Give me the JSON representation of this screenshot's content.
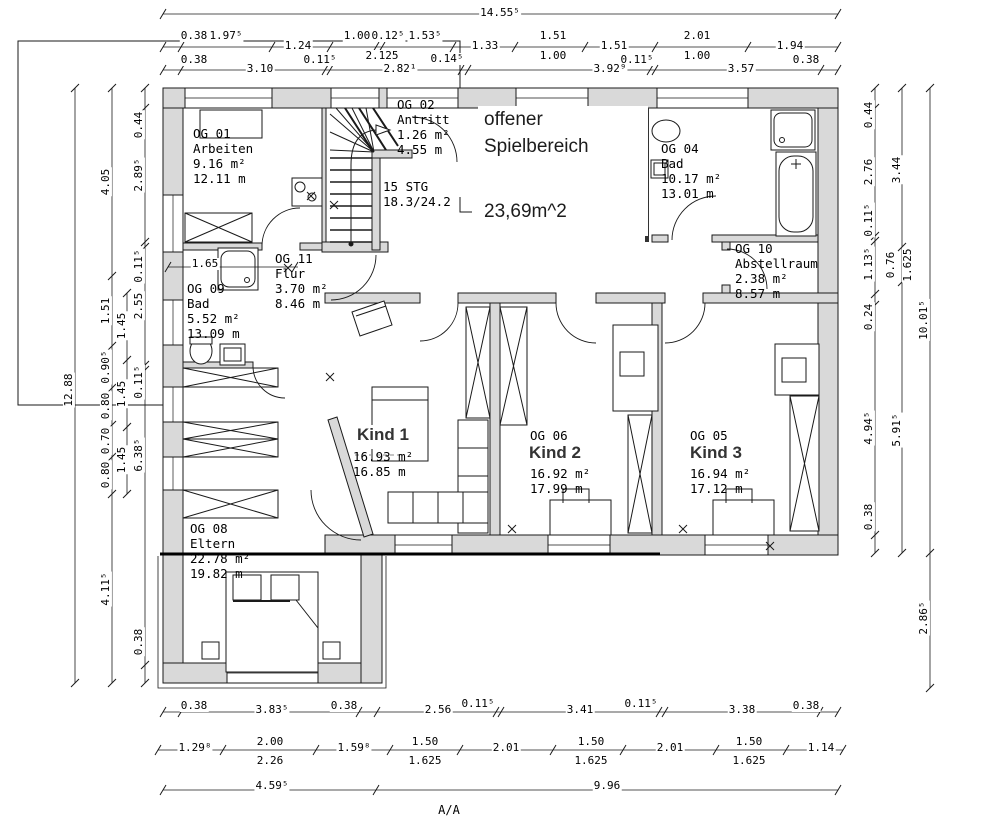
{
  "annotations": {
    "spiel_line1": "offener",
    "spiel_line2": "Spielbereich",
    "spiel_line3": "23,69m^2",
    "kind1": "Kind 1",
    "kind2": "Kind 2",
    "kind3": "Kind 3"
  },
  "rooms": {
    "og01": {
      "id": "OG 01",
      "name": "Arbeiten",
      "area": "9.16 m²",
      "perimeter": "12.11 m"
    },
    "og02": {
      "id": "OG 02",
      "name": "Antritt",
      "area": "1.26 m²",
      "perimeter": "4.55 m"
    },
    "og04": {
      "id": "OG 04",
      "name": "Bad",
      "area": "10.17 m²",
      "perimeter": "13.01 m"
    },
    "og05": {
      "id": "OG 05",
      "area": "16.94 m²",
      "perimeter": "17.12 m"
    },
    "og06": {
      "id": "OG 06",
      "area": "16.92 m²",
      "perimeter": "17.99 m"
    },
    "kind1_stats": {
      "area": "16.93 m²",
      "perimeter": "16.85 m"
    },
    "og08": {
      "id": "OG 08",
      "name": "Eltern",
      "area": "22.78 m²",
      "perimeter": "19.82 m"
    },
    "og09": {
      "id": "OG 09",
      "name": "Bad",
      "area": "5.52 m²",
      "perimeter": "13.09 m"
    },
    "og10": {
      "id": "OG 10",
      "name": "Abstellraum",
      "area": "2.38 m²",
      "perimeter": "8.57 m"
    },
    "og11": {
      "id": "OG 11",
      "name": "Flur",
      "area": "3.70 m²",
      "perimeter": "8.46 m"
    }
  },
  "stair": {
    "label1": "15 STG",
    "label2": "18.3/24.2"
  },
  "section_label": "A/A",
  "dims": {
    "top_total": "14.55⁵",
    "top_row2_upper": [
      "0.38",
      "1.97⁵",
      "1.00",
      "0.12⁵",
      "1.53⁵",
      "1.51",
      "2.01"
    ],
    "top_row2_line": [
      "1.24",
      "1.33",
      "1.51",
      "1.94"
    ],
    "top_row2_lower": [
      "2.125",
      "0.14⁵",
      "1.00",
      "1.00"
    ],
    "top_row3_upper": [
      "0.38",
      "0.11⁵",
      "0.11⁵",
      "0.38"
    ],
    "top_row3_lower": [
      "3.10",
      "2.82¹",
      "3.92⁹",
      "3.57"
    ],
    "left_total": "12.88",
    "left_chain_a": [
      "4.05",
      "1.51",
      "0.90⁵",
      "0.80",
      "0.70",
      "0.80",
      "4.11⁵"
    ],
    "left_chain_b": [
      "1.45",
      "1.45",
      "1.45"
    ],
    "left_chain_c": [
      "0.44",
      "2.89⁵",
      "0.11⁵",
      "2.55",
      "0.11⁵",
      "6.38⁵",
      "0.38"
    ],
    "right_chain_a": [
      "0.44",
      "2.76",
      "0.11⁵",
      "1.13⁵",
      "0.24",
      "4.94⁵",
      "0.38"
    ],
    "right_chain_b": [
      "3.44",
      "0.76",
      "1.625",
      "5.91⁵"
    ],
    "right_total": "10.01⁵",
    "right_lower": "2.86⁵",
    "bottom_row1": [
      "0.38",
      "3.83⁵",
      "0.38",
      "2.56",
      "0.11⁵",
      "3.41",
      "0.11⁵",
      "3.38",
      "0.38"
    ],
    "bottom_row2_main": [
      "1.29⁸",
      "2.00",
      "1.59⁸",
      "1.50",
      "2.01",
      "1.50",
      "2.01",
      "1.50",
      "1.14"
    ],
    "bottom_row2_sub": [
      "2.26",
      "1.625",
      "1.625",
      "1.625"
    ],
    "bottom_row3": [
      "4.59⁵",
      "9.96"
    ],
    "inner_shower": "1.65"
  }
}
